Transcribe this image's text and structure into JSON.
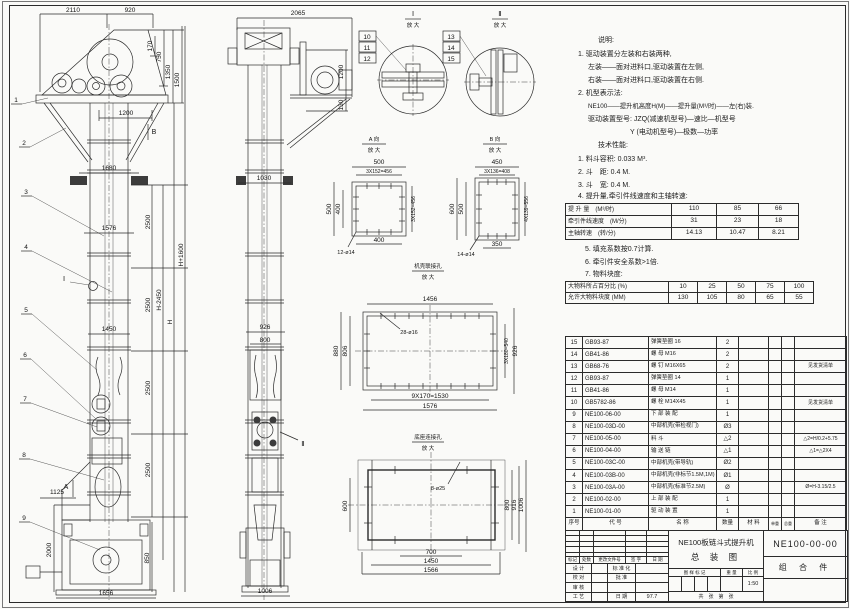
{
  "colors": {
    "paper": "#fafaf8",
    "ink": "#2b2b2b"
  },
  "balloons": [
    "1",
    "2",
    "3",
    "4",
    "5",
    "6",
    "7",
    "8",
    "9"
  ],
  "front_view": {
    "d2110": "2110",
    "d920": "920",
    "d170": "170",
    "d750": "750",
    "d1350": "1350",
    "d1500": "1500",
    "d1200": "1200",
    "mark_b": "B",
    "d1680": "1680",
    "d1576": "1576",
    "d2500": "2500",
    "h_minus": "H-2450",
    "h": "H",
    "h_plus": "H+1600",
    "d1450": "1450",
    "mark_i": "Ⅰ",
    "d1125": "1125",
    "mark_a": "A",
    "d2000": "2000",
    "d850": "850",
    "d1656": "1656"
  },
  "side_view": {
    "d2065": "2065",
    "d1200": "1200",
    "d130": "130",
    "d1030": "1030",
    "d926": "926",
    "d800": "800",
    "mark_ii": "Ⅱ",
    "d1006": "1006"
  },
  "detail_i": {
    "title": "Ⅰ",
    "sub": "放 大",
    "c": [
      "10",
      "11",
      "12"
    ]
  },
  "detail_ii": {
    "title": "Ⅱ",
    "sub": "放 大",
    "c": [
      "13",
      "14",
      "15"
    ]
  },
  "view_a": {
    "title": "A 向",
    "sub": "放 大",
    "t1": "500",
    "t2": "3X152=456",
    "l1": "500",
    "l2": "400",
    "r1": "3X152=456",
    "b1": "400",
    "holes": "12-ø14"
  },
  "view_b": {
    "title": "B 向",
    "sub": "放 大",
    "t1": "450",
    "t2": "3X136=408",
    "l1": "600",
    "l2": "500",
    "r1": "4X139=556",
    "b1": "350",
    "holes": "14-ø14"
  },
  "view_c": {
    "title": "机壳联接孔",
    "sub": "放 大",
    "t1": "1456",
    "holes": "28-ø16",
    "l1": "880",
    "l2": "806",
    "r1": "3X180=540",
    "r2": "926",
    "b1": "9X170=1530",
    "b2": "1576"
  },
  "view_d": {
    "title": "底座连接孔",
    "sub": "放 大",
    "holes": "8-ø25",
    "l1": "600",
    "r1": "800",
    "r2": "916",
    "r3": "1006",
    "b1": "700",
    "b2": "1450",
    "b3": "1566"
  },
  "notes": {
    "heading": "说明:",
    "lines": [
      "1. 驱动装置分左装和右装两种,",
      "左装——面对进料口,驱动装置在左侧,",
      "右装——面对进料口,驱动装置在右侧.",
      "2. 机型表示法:",
      "NE100——提升机高度H(M)——提升量(M³/时)——左(右)装.",
      "驱动装置型号: JZQ(减速机型号)—速比—机型号",
      "Y (电动机型号)—极数—功率"
    ]
  },
  "tech": {
    "heading": "技术性能:",
    "items_top": [
      "1. 料斗容积: 0.033 M³.",
      "2. 斗　距: 0.4 M.",
      "3. 斗　宽: 0.4 M.",
      "4. 提升量,牵引件线速度和主轴转速:"
    ],
    "items_bottom": [
      "5. 填充系数按0.7计算.",
      "6. 牵引件安全系数>1倍.",
      "7. 物料块度:"
    ]
  },
  "perf_table": {
    "rows": [
      {
        "label": "提 升 量　(M³/时)",
        "v": [
          "110",
          "85",
          "66"
        ]
      },
      {
        "label": "牵引件线速度　(M/分)",
        "v": [
          "31",
          "23",
          "18"
        ]
      },
      {
        "label": "主轴转速　(转/分)",
        "v": [
          "14.13",
          "10.47",
          "8.21"
        ]
      }
    ]
  },
  "size_table": {
    "rows": [
      {
        "label": "大物料所占百分比 (%)",
        "v": [
          "10",
          "25",
          "50",
          "75",
          "100"
        ]
      },
      {
        "label": "允许大物料块度 (MM)",
        "v": [
          "130",
          "105",
          "80",
          "65",
          "55"
        ]
      }
    ]
  },
  "bom": {
    "headers": [
      "序号",
      "代  号",
      "名  称",
      "数量",
      "材  料",
      "单重",
      "总重",
      "备  注"
    ],
    "rows": [
      {
        "no": "15",
        "code": "GB93-87",
        "name": "弹簧垫圈  16",
        "qty": "2",
        "remark": ""
      },
      {
        "no": "14",
        "code": "GB41-86",
        "name": "螺  母  M16",
        "qty": "2",
        "remark": ""
      },
      {
        "no": "13",
        "code": "GB68-76",
        "name": "螺  钉  M16X65",
        "qty": "2",
        "remark": "见发货清单"
      },
      {
        "no": "12",
        "code": "GB93-87",
        "name": "弹簧垫圈  14",
        "qty": "1",
        "remark": ""
      },
      {
        "no": "11",
        "code": "GB41-86",
        "name": "螺  母  M14",
        "qty": "1",
        "remark": ""
      },
      {
        "no": "10",
        "code": "GB5782-86",
        "name": "螺  栓  M14X45",
        "qty": "1",
        "remark": "见发货清单"
      },
      {
        "no": "9",
        "code": "NE100-06-00",
        "name": "下 部 装 配",
        "qty": "1",
        "remark": ""
      },
      {
        "no": "8",
        "code": "NE100-03D-00",
        "name": "中部机壳(带检视门)",
        "qty": "Ø3",
        "remark": ""
      },
      {
        "no": "7",
        "code": "NE100-05-00",
        "name": "料  斗",
        "qty": "△2",
        "remark": "△2=H/0.2+5.75"
      },
      {
        "no": "6",
        "code": "NE100-04-00",
        "name": "输 送 链",
        "qty": "△1",
        "remark": "△1=△2X4"
      },
      {
        "no": "5",
        "code": "NE100-03C-00",
        "name": "中部机壳(带导轨)",
        "qty": "Ø2",
        "remark": ""
      },
      {
        "no": "4",
        "code": "NE100-03B-00",
        "name": "中部机壳(非标节1.5M,1M)",
        "qty": "Ø1",
        "remark": ""
      },
      {
        "no": "3",
        "code": "NE100-03A-00",
        "name": "中部机壳(标准节2.5M)",
        "qty": "Ø",
        "remark": "Ø=H-3.15/2.5"
      },
      {
        "no": "2",
        "code": "NE100-02-00",
        "name": "上 部 装 配",
        "qty": "1",
        "remark": ""
      },
      {
        "no": "1",
        "code": "NE100-01-00",
        "name": "驱 动 装 置",
        "qty": "1",
        "remark": ""
      }
    ]
  },
  "title_block": {
    "rev_cols": [
      "标记",
      "处数",
      "更改文件号",
      "签 字",
      "日 期"
    ],
    "rows": [
      {
        "a": "设 计",
        "b": "标 准 化",
        "c": ""
      },
      {
        "a": "校 对",
        "b": "批  准",
        "c": ""
      },
      {
        "a": "审 核",
        "b": "",
        "c": ""
      },
      {
        "a": "工 艺",
        "b": "日 期",
        "c": "97.7"
      }
    ],
    "title1": "NE100板链斗式提升机",
    "title2": "总  装  图",
    "mid_cols": [
      "图 样 标 记",
      "重 量",
      "比 例"
    ],
    "scale": "1:50",
    "sheet": "共　张　第　张",
    "drawing_no": "NE100-00-00",
    "part_kind": "组 合 件"
  }
}
